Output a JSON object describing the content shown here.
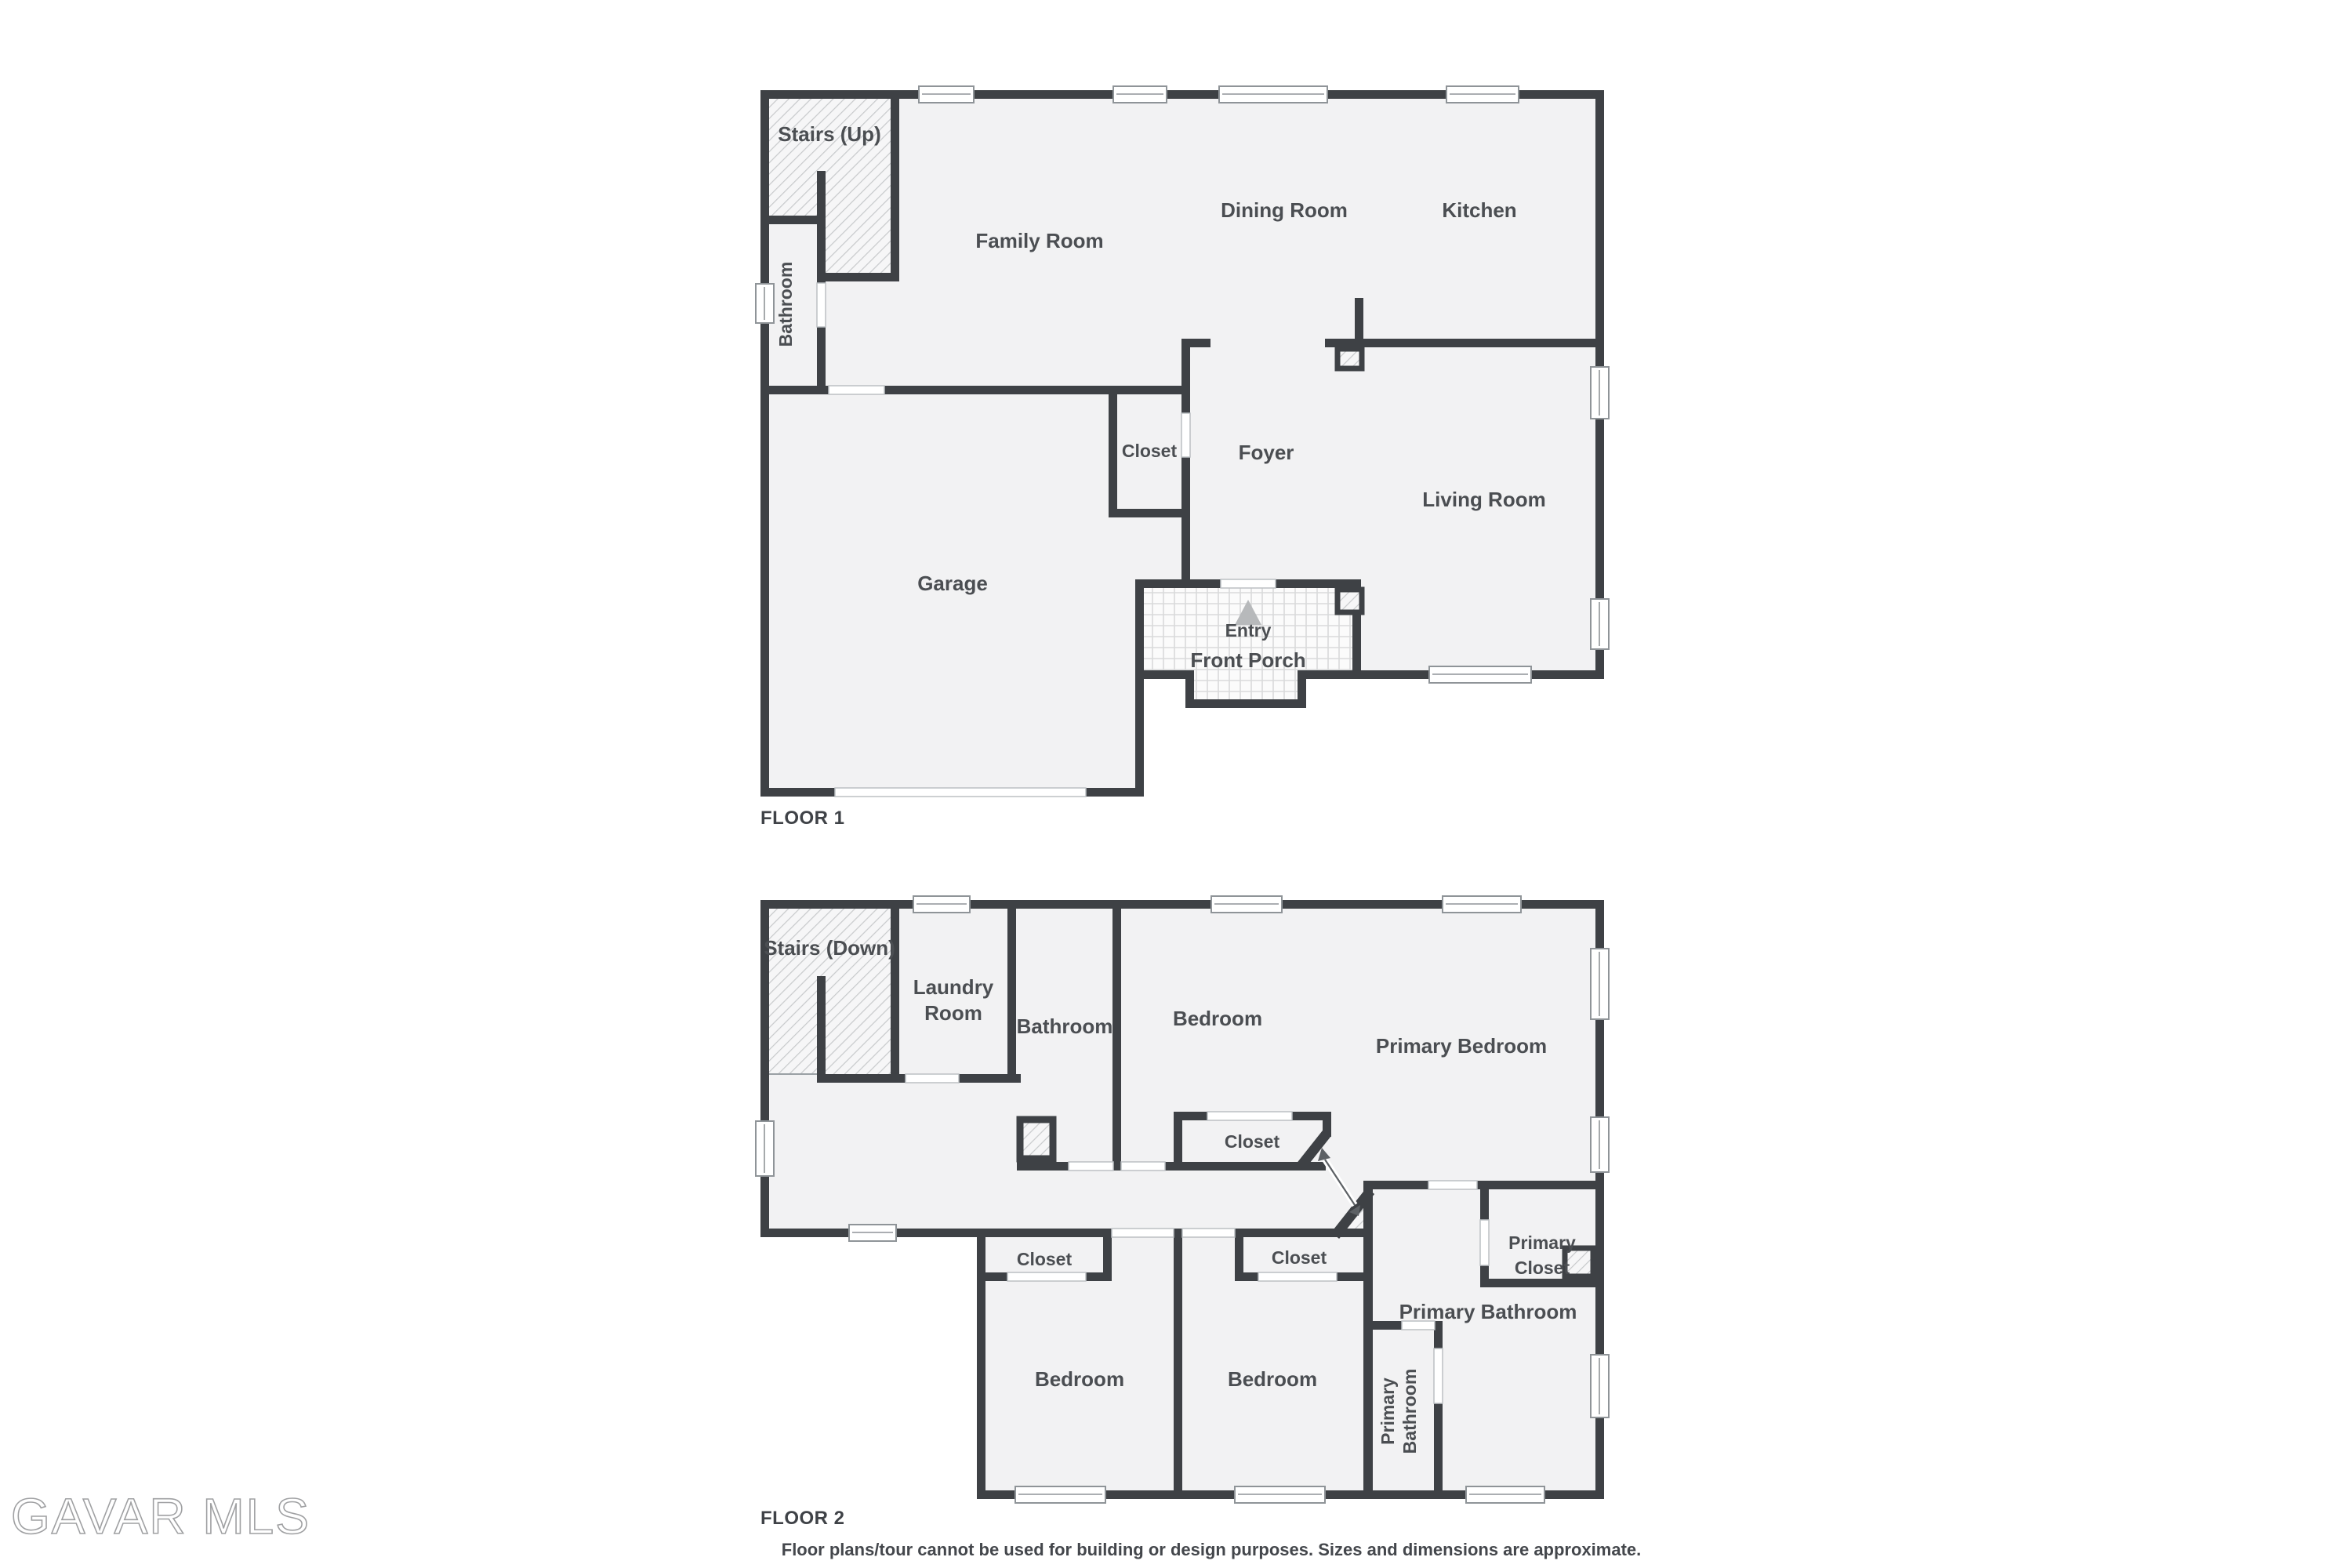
{
  "floor1": {
    "tag": "FLOOR 1",
    "rooms": {
      "stairs": "Stairs (Up)",
      "bathroom": "Bathroom",
      "family_room": "Family Room",
      "dining_room": "Dining Room",
      "kitchen": "Kitchen",
      "closet": "Closet",
      "foyer": "Foyer",
      "living_room": "Living Room",
      "garage": "Garage",
      "entry": "Entry",
      "front_porch": "Front Porch"
    }
  },
  "floor2": {
    "tag": "FLOOR 2",
    "rooms": {
      "stairs": "Stairs (Down)",
      "laundry_l1": "Laundry",
      "laundry_l2": "Room",
      "bathroom": "Bathroom",
      "bedroom_top": "Bedroom",
      "primary_bedroom": "Primary Bedroom",
      "closet_center": "Closet",
      "closet_left": "Closet",
      "closet_mid": "Closet",
      "primary_closet_l1": "Primary",
      "primary_closet_l2": "Closet",
      "primary_bathroom": "Primary Bathroom",
      "bedroom_left": "Bedroom",
      "bedroom_mid": "Bedroom",
      "primary_bathroom_small_l1": "Primary",
      "primary_bathroom_small_l2": "Bathroom"
    }
  },
  "footer": {
    "disclaimer": "Floor plans/tour cannot be used for building or design purposes. Sizes and dimensions are approximate."
  },
  "watermark": "GAVAR MLS",
  "colors": {
    "wall": "#3e4145",
    "floor": "#f2f2f3",
    "label": "#4b4e52"
  }
}
